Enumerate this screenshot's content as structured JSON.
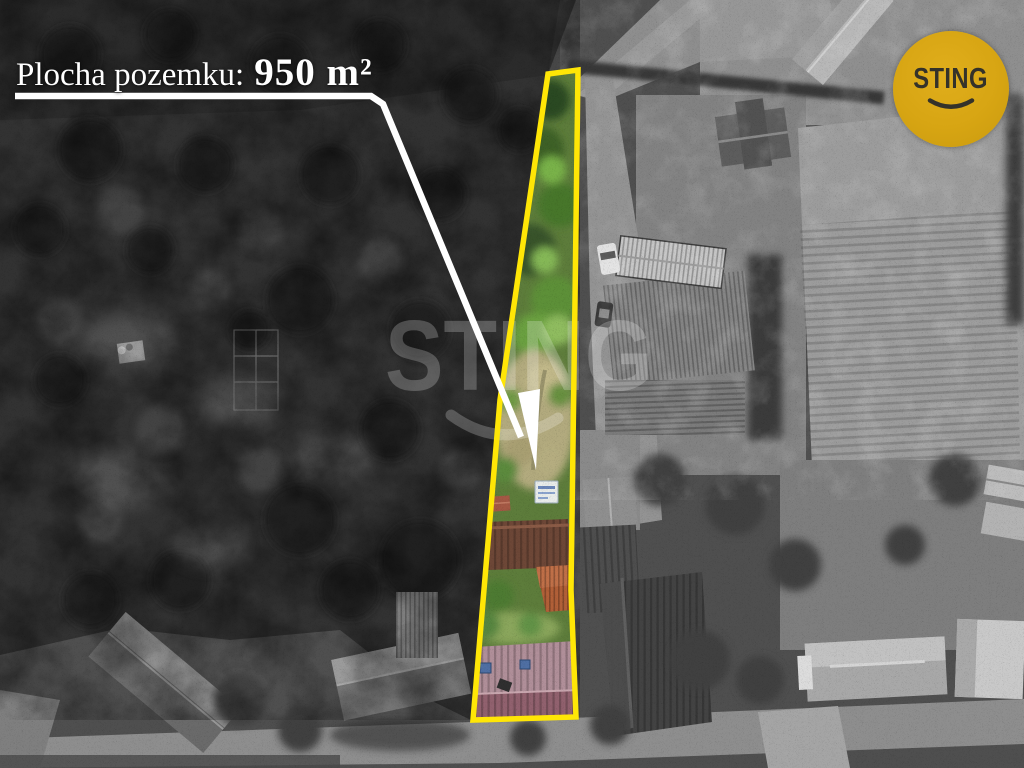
{
  "annotation": {
    "label_prefix": "Plocha pozemku:",
    "label_value": "950 m²",
    "outline_color": "#ffe606",
    "pointer_color": "#ffffff"
  },
  "watermark": {
    "text": "STING"
  },
  "logo": {
    "text": "STING",
    "background_color": "#d7a513",
    "text_color": "#34322a"
  }
}
